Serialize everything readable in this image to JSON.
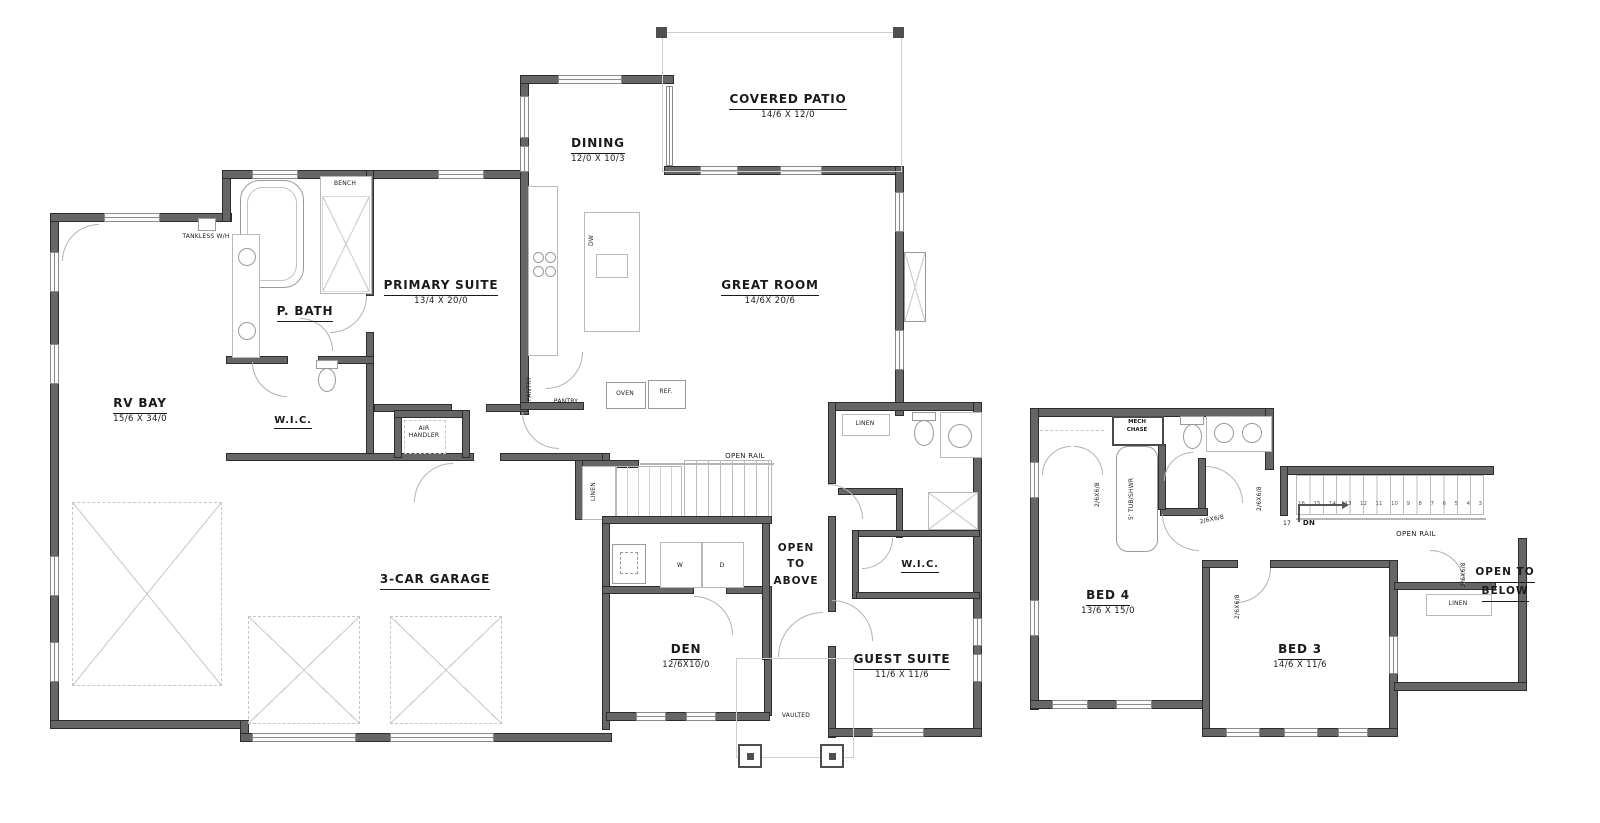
{
  "colors": {
    "wall": "#666666",
    "wall_edge": "#2d2d2d",
    "fixture_line": "#9a9a9a",
    "text": "#1a1a1a",
    "background": "#ffffff"
  },
  "main_floor": {
    "rooms": {
      "covered_patio": {
        "name": "COVERED PATIO",
        "dims": "14/6 X 12/0"
      },
      "dining": {
        "name": "DINING",
        "dims": "12/0 X 10/3"
      },
      "great_room": {
        "name": "GREAT ROOM",
        "dims": "14/6X 20/6"
      },
      "primary_suite": {
        "name": "PRIMARY SUITE",
        "dims": "13/4 X 20/0"
      },
      "p_bath": {
        "name": "P. BATH"
      },
      "rv_bay": {
        "name": "RV BAY",
        "dims": "15/6 X 34/0"
      },
      "wic": {
        "name": "W.I.C."
      },
      "garage": {
        "name": "3-CAR GARAGE"
      },
      "den": {
        "name": "DEN",
        "dims": "12/6X10/0"
      },
      "guest_suite": {
        "name": "GUEST SUITE",
        "dims": "11/6 X 11/6"
      },
      "guest_wic": {
        "name": "W.I.C."
      }
    },
    "annotations": {
      "tankless": "TANKLESS W/H",
      "bench": "BENCH",
      "air_handler_1": "AIR",
      "air_handler_2": "HANDLER",
      "pantry_v": "PANTRY",
      "pantry_h": "PANTRY",
      "oven": "OVEN",
      "ref": "REF.",
      "dw": "DW",
      "linen_hall": "LINEN",
      "linen_guest": "LINEN",
      "open_rail": "OPEN RAIL",
      "washer": "W",
      "dryer": "D",
      "open_to_above_1": "OPEN",
      "open_to_above_2": "TO",
      "open_to_above_3": "ABOVE",
      "vaulted": "VAULTED"
    }
  },
  "upper_floor": {
    "rooms": {
      "bed4": {
        "name": "BED 4",
        "dims": "13/6 X 15/0"
      },
      "bed3": {
        "name": "BED 3",
        "dims": "14/6 X 11/6"
      }
    },
    "annotations": {
      "mech_chase_1": "MECH",
      "mech_chase_2": "CHASE",
      "tub_shwr": "5' TUB/SHWR",
      "linen": "LINEN",
      "open_rail": "OPEN RAIL",
      "open_to_below_1": "OPEN TO",
      "open_to_below_2": "BELOW",
      "down": "DN",
      "landing_number": "17",
      "door_size": "2/6X6/8",
      "stair_numbers": [
        "16",
        "15",
        "14",
        "13",
        "12",
        "11",
        "10",
        "9",
        "8",
        "7",
        "6",
        "5",
        "4",
        "3"
      ]
    }
  }
}
